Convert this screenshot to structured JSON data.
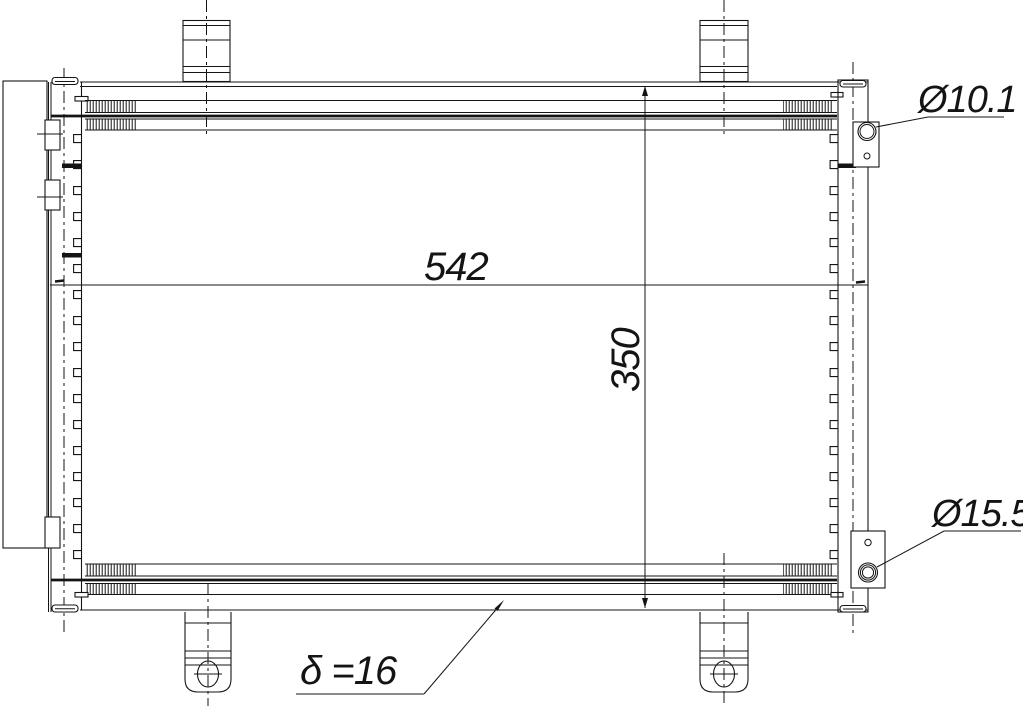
{
  "drawing": {
    "type": "technical-drawing-condenser",
    "background": "#ffffff",
    "line_color": "#141414",
    "dimensions": {
      "core_width_label": "542",
      "core_height_label": "350",
      "top_port_diameter_label": "Ø10.1",
      "bottom_port_diameter_label": "Ø15.5",
      "core_thickness_label": "δ =16"
    }
  }
}
